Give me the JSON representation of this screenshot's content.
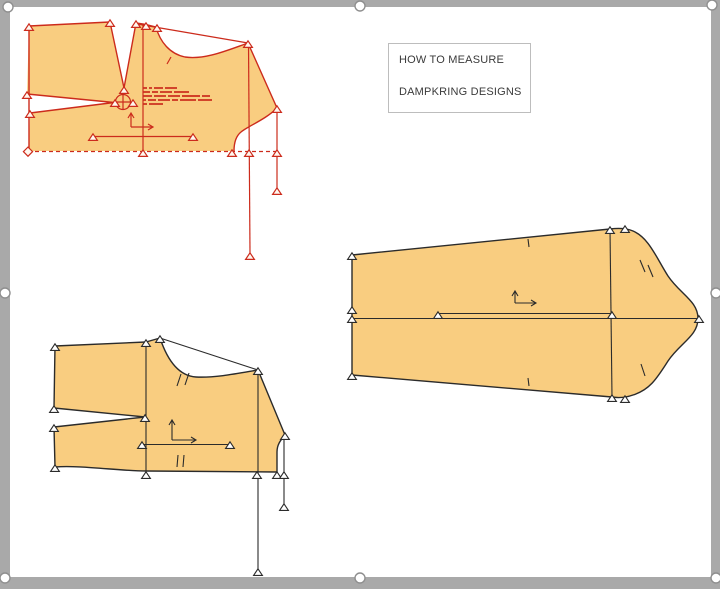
{
  "label_box": {
    "line1": "HOW TO MEASURE",
    "line2": "DAMPKRING DESIGNS"
  },
  "colors": {
    "piece_fill": "#f9cd80",
    "red_outline": "#cc2b1c",
    "black_outline": "#2b2b2b",
    "frame_gray": "#a9a9a9",
    "page_white": "#ffffff",
    "textbox_border": "#bdbdbd",
    "textbox_text": "#3a3a3a"
  },
  "icons": {
    "grading_triangle": "grading-point-marker",
    "pivot_circle": "pivot-point-icon",
    "grain_axes": "grain-axis-icon",
    "selection_handle": "selection-handle"
  },
  "selection": {
    "handle_count": 8
  }
}
